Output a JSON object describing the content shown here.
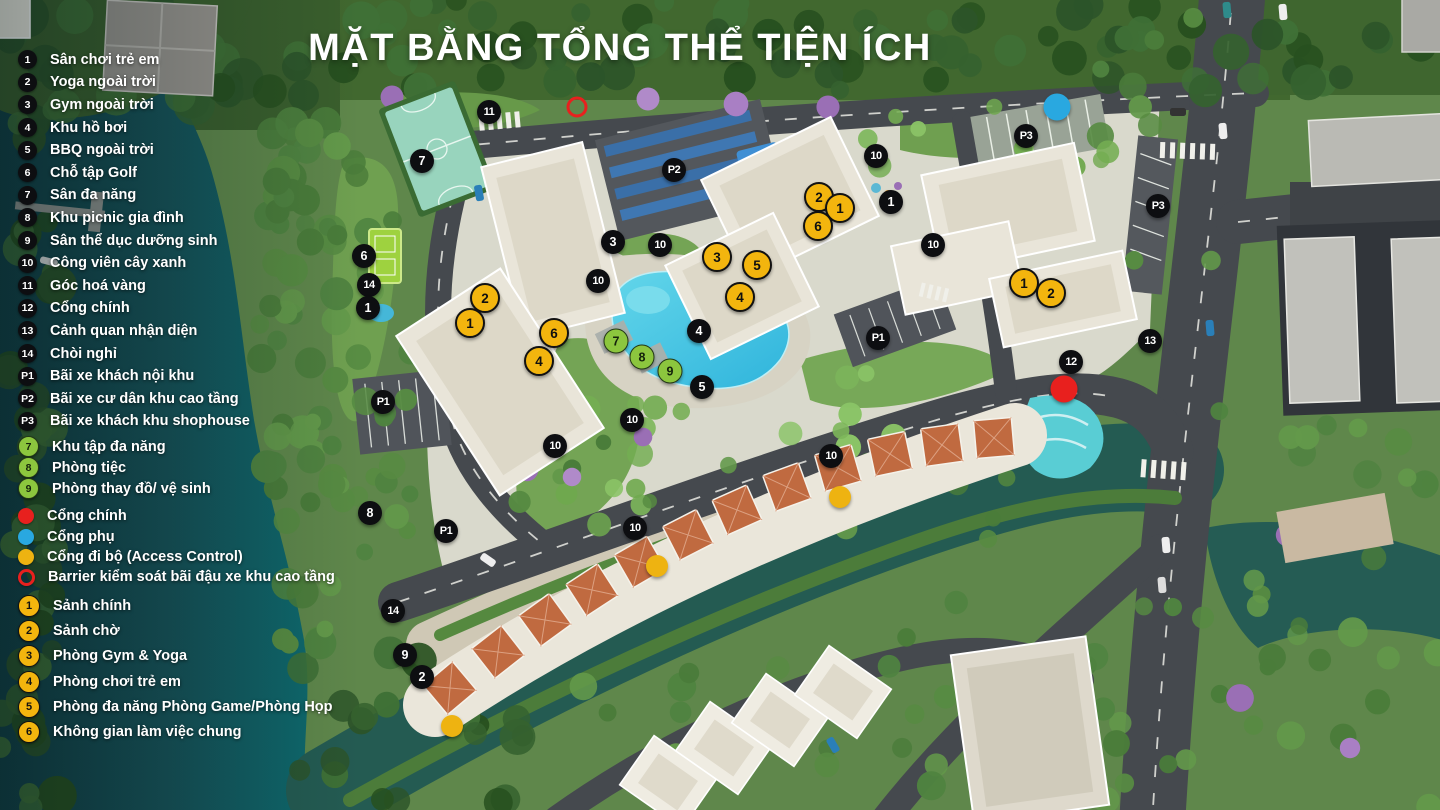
{
  "title": "MẶT BẰNG TỔNG THỂ TIỆN ÍCH",
  "colors": {
    "marker_black": "#0d0e11",
    "marker_yellow": "#f3b50e",
    "marker_green": "#8cc63e",
    "gate_red": "#e8201e",
    "gate_blue": "#29a8e0",
    "gate_amber": "#eeb311",
    "pool": "#3fc3e0",
    "river": "#17535a"
  },
  "legend": {
    "numbered_black": [
      {
        "id": "1",
        "label": "Sân chơi trẻ em"
      },
      {
        "id": "2",
        "label": "Yoga ngoài trời"
      },
      {
        "id": "3",
        "label": "Gym ngoài trời"
      },
      {
        "id": "4",
        "label": "Khu hồ bơi"
      },
      {
        "id": "5",
        "label": "BBQ ngoài trời"
      },
      {
        "id": "6",
        "label": "Chỗ tập Golf"
      },
      {
        "id": "7",
        "label": "Sân đa năng"
      },
      {
        "id": "8",
        "label": "Khu picnic gia đình"
      },
      {
        "id": "9",
        "label": "Sân thể dục dưỡng sinh"
      },
      {
        "id": "10",
        "label": "Công viên cây xanh"
      },
      {
        "id": "11",
        "label": "Góc hoá vàng"
      },
      {
        "id": "12",
        "label": "Cổng chính"
      },
      {
        "id": "13",
        "label": "Cảnh quan nhận diện"
      },
      {
        "id": "14",
        "label": "Chòi nghỉ"
      },
      {
        "id": "P1",
        "label": "Bãi xe khách nội khu"
      },
      {
        "id": "P2",
        "label": "Bãi xe cư dân khu cao tầng"
      },
      {
        "id": "P3",
        "label": "Bãi xe khách khu shophouse"
      }
    ],
    "numbered_green": [
      {
        "id": "7",
        "label": "Khu tập đa năng"
      },
      {
        "id": "8",
        "label": "Phòng tiệc"
      },
      {
        "id": "9",
        "label": "Phòng thay đồ/ vệ sinh"
      }
    ],
    "gates": [
      {
        "type": "red",
        "label": "Cổng chính"
      },
      {
        "type": "blue",
        "label": "Cổng phụ"
      },
      {
        "type": "amber",
        "label": "Cổng đi bộ (Access Control)"
      },
      {
        "type": "ring",
        "label": "Barrier kiểm soát bãi đậu xe khu cao tầng"
      }
    ],
    "numbered_yellow": [
      {
        "id": "1",
        "label": "Sảnh chính"
      },
      {
        "id": "2",
        "label": "Sảnh chờ"
      },
      {
        "id": "3",
        "label": "Phòng Gym & Yoga"
      },
      {
        "id": "4",
        "label": "Phòng chơi trẻ em"
      },
      {
        "id": "5",
        "label": "Phòng đa năng Phòng Game/Phòng Họp"
      },
      {
        "id": "6",
        "label": "Không gian làm việc chung"
      }
    ]
  },
  "map_markers": {
    "black": [
      {
        "id": "11",
        "x": 489,
        "y": 112
      },
      {
        "id": "7",
        "x": 422,
        "y": 161
      },
      {
        "id": "P2",
        "x": 674,
        "y": 170
      },
      {
        "id": "10",
        "x": 876,
        "y": 156
      },
      {
        "id": "P3",
        "x": 1026,
        "y": 136
      },
      {
        "id": "1",
        "x": 891,
        "y": 202
      },
      {
        "id": "P3",
        "x": 1158,
        "y": 206
      },
      {
        "id": "3",
        "x": 613,
        "y": 242
      },
      {
        "id": "10",
        "x": 660,
        "y": 245
      },
      {
        "id": "10",
        "x": 933,
        "y": 245
      },
      {
        "id": "6",
        "x": 364,
        "y": 256
      },
      {
        "id": "14",
        "x": 369,
        "y": 285
      },
      {
        "id": "10",
        "x": 598,
        "y": 281
      },
      {
        "id": "1",
        "x": 368,
        "y": 308
      },
      {
        "id": "4",
        "x": 699,
        "y": 331
      },
      {
        "id": "P1",
        "x": 878,
        "y": 338
      },
      {
        "id": "13",
        "x": 1150,
        "y": 341
      },
      {
        "id": "12",
        "x": 1071,
        "y": 362
      },
      {
        "id": "5",
        "x": 702,
        "y": 387
      },
      {
        "id": "P1",
        "x": 383,
        "y": 402
      },
      {
        "id": "10",
        "x": 632,
        "y": 420
      },
      {
        "id": "10",
        "x": 555,
        "y": 446
      },
      {
        "id": "10",
        "x": 831,
        "y": 456
      },
      {
        "id": "8",
        "x": 370,
        "y": 513
      },
      {
        "id": "P1",
        "x": 446,
        "y": 531
      },
      {
        "id": "10",
        "x": 635,
        "y": 528
      },
      {
        "id": "14",
        "x": 393,
        "y": 611
      },
      {
        "id": "9",
        "x": 405,
        "y": 655
      },
      {
        "id": "2",
        "x": 422,
        "y": 677
      }
    ],
    "yellow": [
      {
        "id": "2",
        "x": 819,
        "y": 197
      },
      {
        "id": "1",
        "x": 840,
        "y": 208
      },
      {
        "id": "6",
        "x": 818,
        "y": 226
      },
      {
        "id": "3",
        "x": 717,
        "y": 257
      },
      {
        "id": "5",
        "x": 757,
        "y": 265
      },
      {
        "id": "4",
        "x": 740,
        "y": 297
      },
      {
        "id": "1",
        "x": 1024,
        "y": 283
      },
      {
        "id": "2",
        "x": 1051,
        "y": 293
      },
      {
        "id": "2",
        "x": 485,
        "y": 298
      },
      {
        "id": "1",
        "x": 470,
        "y": 323
      },
      {
        "id": "6",
        "x": 554,
        "y": 333
      },
      {
        "id": "4",
        "x": 539,
        "y": 361
      }
    ],
    "green": [
      {
        "id": "7",
        "x": 616,
        "y": 341
      },
      {
        "id": "8",
        "x": 642,
        "y": 357
      },
      {
        "id": "9",
        "x": 670,
        "y": 371
      }
    ],
    "gates": [
      {
        "type": "red",
        "x": 1064,
        "y": 389
      },
      {
        "type": "blue",
        "x": 1057,
        "y": 107
      },
      {
        "type": "amber",
        "x": 840,
        "y": 497
      },
      {
        "type": "amber",
        "x": 657,
        "y": 566
      },
      {
        "type": "amber",
        "x": 452,
        "y": 726
      },
      {
        "type": "ring",
        "x": 577,
        "y": 107
      }
    ]
  }
}
